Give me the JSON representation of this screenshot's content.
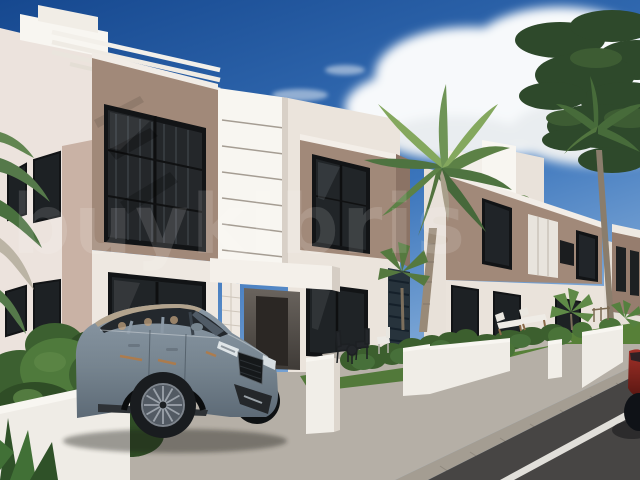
{
  "watermark": {
    "text": "buykibris"
  },
  "scene": {
    "elements": [
      "sky",
      "clouds",
      "dark-tree",
      "palm-trees",
      "modern-villas",
      "suv-car",
      "garden-walls",
      "hedges",
      "lawn",
      "sidewalk",
      "road",
      "outdoor-furniture",
      "red-car-edge"
    ]
  },
  "colors": {
    "sky_top": "#16488f",
    "sky_mid": "#3a74bb",
    "sky_horizon": "#9dc0e4",
    "cloud": "#f7f9fb",
    "wall_white": "#f2eee7",
    "wall_shade": "#e3dad3",
    "wall_bright": "#f8f6f1",
    "taupe": "#a18979",
    "taupe_shade": "#8b7365",
    "taupe_side": "#c9b2a5",
    "window_dark": "#1d2124",
    "window_frame": "#121416",
    "sidewalk": "#b5afa6",
    "curb": "#a49d92",
    "road": "#474544",
    "road_marking": "#efede7",
    "lawn": "#578038",
    "hedge": "#3c5f2e",
    "palm_green": "#5c8146",
    "palm_light": "#84a85e",
    "tree_dark": "#2e492b",
    "trunk": "#998a78",
    "car_body": "#8b99a6",
    "car_body_dark": "#5d6a76",
    "car_roof": "#b2a38d",
    "car_glass": "#23282d",
    "car_accent": "#b57a42",
    "red_car": "#8f2721",
    "watermark": "rgba(255,255,255,0.13)"
  }
}
